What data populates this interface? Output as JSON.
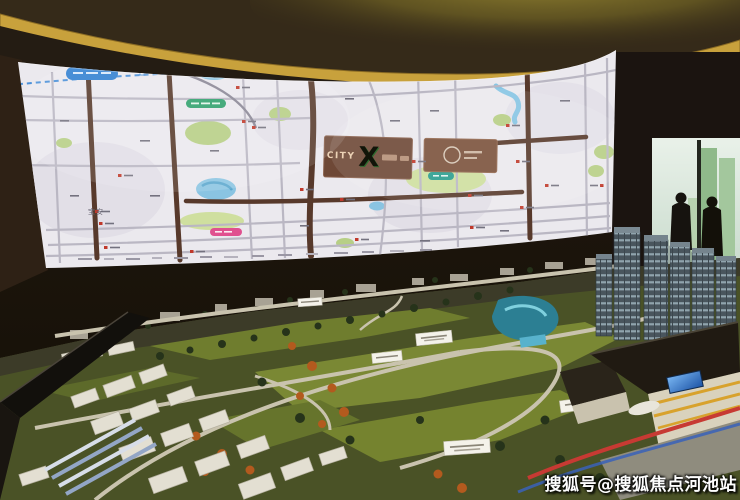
{
  "photo": {
    "watermark": "搜狐号@搜狐焦点河池站"
  },
  "screen_map": {
    "billboard": {
      "brand": "CITY",
      "x_mark": "X"
    },
    "district_label": "宝安"
  },
  "colors": {
    "map_bg": "#ebe9ee",
    "road_dark": "#57392b",
    "park_green": "#b7cf85",
    "water_blue": "#8ac4e2",
    "billboard_brown": "#6e4836",
    "ceiling_gold": "#c8a13c",
    "model_green": "#717d2f",
    "accent_red": "#c73a33",
    "pill_blue": "#2f7fd1",
    "pill_green": "#2ea06b",
    "pill_pink": "#e0508f"
  }
}
